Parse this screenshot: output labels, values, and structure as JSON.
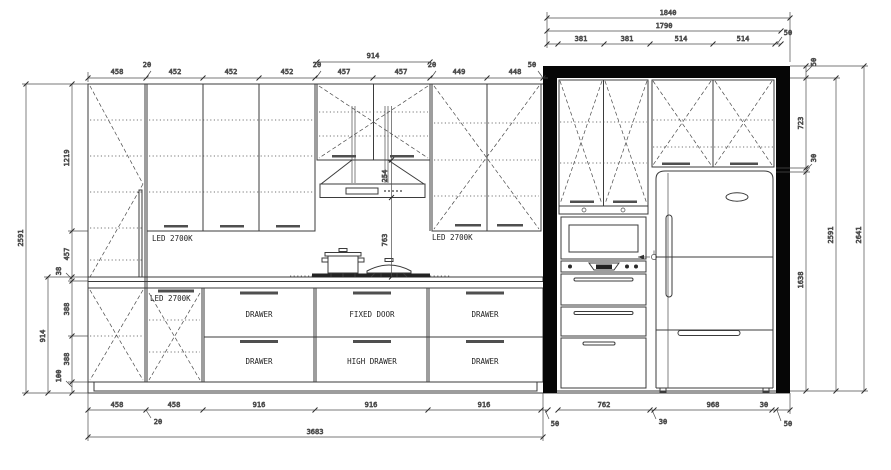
{
  "labels": {
    "led_backsplash_left": "LED 2700K",
    "led_backsplash_right": "LED 2700K",
    "led_base": "LED 2700K",
    "base_row1": [
      "DRAWER",
      "FIXED DOOR",
      "DRAWER"
    ],
    "base_row2": [
      "DRAWER",
      "HIGH DRAWER",
      "DRAWER"
    ]
  },
  "dims": {
    "top_right": {
      "total": "1840",
      "inner": "1790",
      "segs": [
        "381",
        "381",
        "514",
        "514"
      ],
      "wall": "50"
    },
    "top_main": {
      "segs": [
        "458",
        "452",
        "452",
        "452",
        "457",
        "457",
        "449",
        "448"
      ],
      "fillers": [
        "20",
        "20",
        "20"
      ],
      "wall": "50",
      "hood_span": "914"
    },
    "left": {
      "overall": "2591",
      "segs": [
        "1219",
        "457",
        "38",
        "388",
        "388",
        "100"
      ],
      "base_span": "914"
    },
    "right": {
      "wall": "50",
      "upper_cab": "723",
      "gap": "30",
      "tall_zone": "1638",
      "inner_overall": "2591",
      "overall": "2641"
    },
    "hood": {
      "cab_to_hood": "254",
      "hood_to_counter": "763"
    },
    "bottom_main": {
      "segs": [
        "458",
        "458",
        "916",
        "916",
        "916"
      ],
      "filler": "20",
      "wall": "50",
      "overall": "3683"
    },
    "bottom_right": {
      "segs": [
        "762",
        "968"
      ],
      "gap": "30",
      "end_gap": "30",
      "wall": "50"
    }
  },
  "colors": {
    "line": "#3b3b3b",
    "wall": "#060606",
    "handle": "#4f4f4f"
  }
}
